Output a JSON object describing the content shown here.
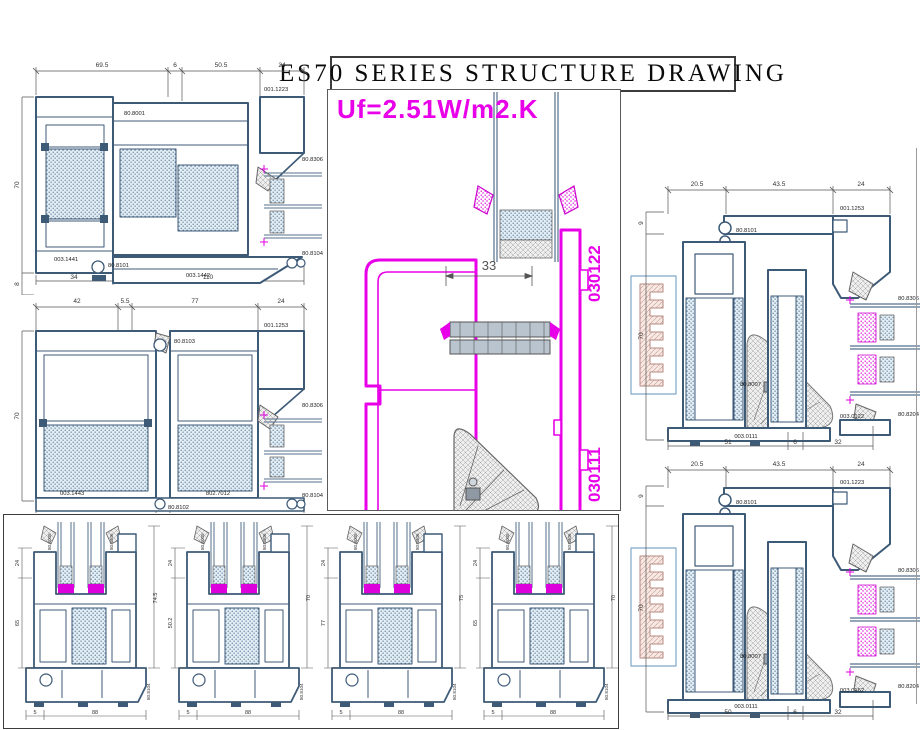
{
  "title": "ES70 SERIES STRUCTURE DRAWING",
  "uf_value": "Uf=2.51W/m2.K",
  "colors": {
    "profile": "#3d5a77",
    "accent_magenta": "#e800e8",
    "hatch_blue": "#e3edf4",
    "dim_text": "#333333"
  },
  "central": {
    "code_top": "030122",
    "code_bottom": "030111",
    "dim_33": "33"
  },
  "top_left": {
    "dims_top": [
      "69.5",
      "6",
      "50.5",
      "24"
    ],
    "dim_left": "70",
    "dim_left_b": "8",
    "dims_bottom": [
      "34",
      "110"
    ],
    "label_top_center": "80.8001",
    "label_top_right": "001.1223",
    "label_right": "80.8306",
    "label_right_b": "80.8104",
    "label_bottom_left": "003.1441",
    "label_bottom_center": "80.8101",
    "label_bottom_right": "003.1442"
  },
  "mid_left": {
    "dims_top": [
      "42",
      "5.5",
      "77",
      "24"
    ],
    "dim_left": "70",
    "dims_bottom": [
      "82",
      "5.5",
      "75"
    ],
    "label_top_center": "80.8103",
    "label_top_right": "001.1253",
    "label_right": "80.8306",
    "label_right_b": "80.8104",
    "label_bottom_left": "003.1443",
    "label_bottom_center": "80.8102",
    "label_bottom_right": "802.7012"
  },
  "right_top": {
    "dims_top": [
      "20.5",
      "43.5",
      "24"
    ],
    "dim_left_top": "9",
    "dim_left": "70",
    "dims_bottom": [
      "51",
      "6",
      "32"
    ],
    "label_top_right": "001.1253",
    "label_clip": "80.8101",
    "label_glass_top": "80.8306",
    "label_arc": "80.8007",
    "label_bottom_left": "003.0111",
    "label_bottom_right": "003.0122",
    "label_glass_bottom": "80.8204"
  },
  "right_bottom": {
    "dims_top": [
      "20.5",
      "43.5",
      "24"
    ],
    "dim_left_top": "9",
    "dim_left": "70",
    "dims_bottom": [
      "50",
      "6",
      "32"
    ],
    "label_top_right": "001.1223",
    "label_clip": "80.8101",
    "label_glass_top": "80.8306",
    "label_arc": "80.8007",
    "label_bottom_left": "003.0111",
    "label_bottom_right": "003.0162",
    "label_glass_bottom": "80.8204"
  },
  "bottom_sections": [
    {
      "dim_top": "24",
      "dim_mid": "65",
      "dim_far": "74.5",
      "glass_left": "80.8005",
      "glass_right": "80.8306",
      "sill_code": "80.8104",
      "dims_bottom": [
        "5",
        "88"
      ]
    },
    {
      "dim_top": "24",
      "dim_mid": "50.2",
      "dim_far": "70",
      "glass_left": "80.8005",
      "glass_right": "80.8306",
      "sill_code": "80.8104",
      "dims_bottom": [
        "5",
        "88"
      ]
    },
    {
      "dim_top": "24",
      "dim_mid": "77",
      "dim_far": "75",
      "glass_left": "80.8005",
      "glass_right": "80.8306",
      "sill_code": "80.8104",
      "dims_bottom": [
        "5",
        "88"
      ]
    },
    {
      "dim_top": "24",
      "dim_mid": "65",
      "dim_far": "70",
      "glass_left": "80.8005",
      "glass_right": "80.8306",
      "sill_code": "80.8104",
      "dims_bottom": [
        "5",
        "88"
      ]
    }
  ]
}
